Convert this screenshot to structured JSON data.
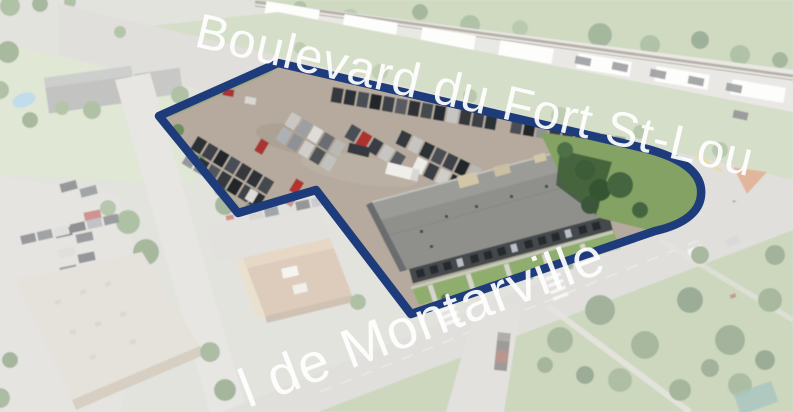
{
  "map": {
    "street_labels": {
      "top": "Boulevard du Fort St-Lou",
      "bottom": "l de Montarville"
    },
    "colors": {
      "boundary": "#1e3c7c",
      "label": "#ffffff"
    }
  }
}
